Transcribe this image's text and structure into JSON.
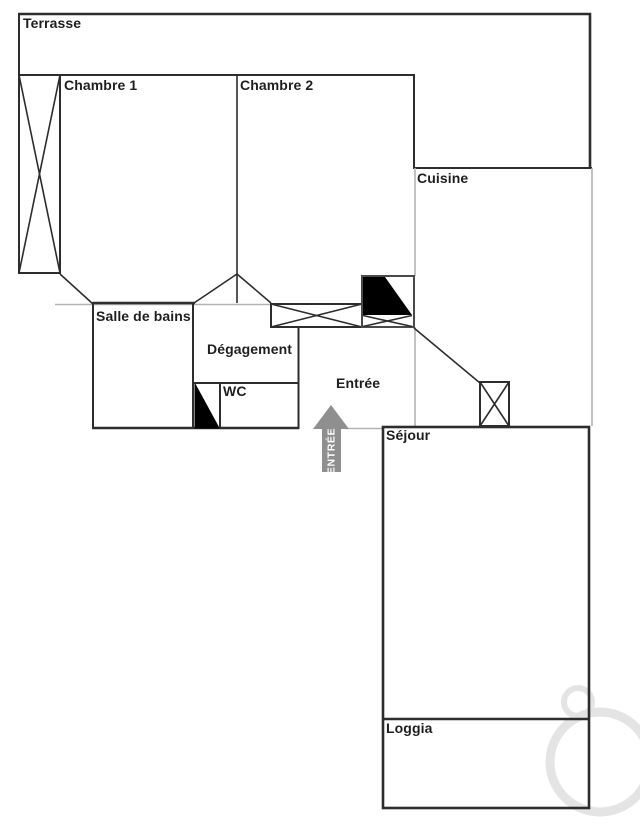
{
  "rooms": {
    "terrasse": {
      "label": "Terrasse"
    },
    "chambre1": {
      "label": "Chambre 1"
    },
    "chambre2": {
      "label": "Chambre 2"
    },
    "cuisine": {
      "label": "Cuisine"
    },
    "salle_de_bains": {
      "label": "Salle de bains"
    },
    "degagement": {
      "label": "Dégagement"
    },
    "wc": {
      "label": "WC"
    },
    "entree": {
      "label": "Entrée"
    },
    "sejour": {
      "label": "Séjour"
    },
    "loggia": {
      "label": "Loggia"
    }
  },
  "entrance_arrow": {
    "label": "ENTRÉE"
  },
  "colors": {
    "wall": "#2d2d2d",
    "wall_light": "#b3b3b3",
    "arrow": "#8f8f8f",
    "label": "#1f1f1f",
    "watermark": "#e4e4e4"
  }
}
